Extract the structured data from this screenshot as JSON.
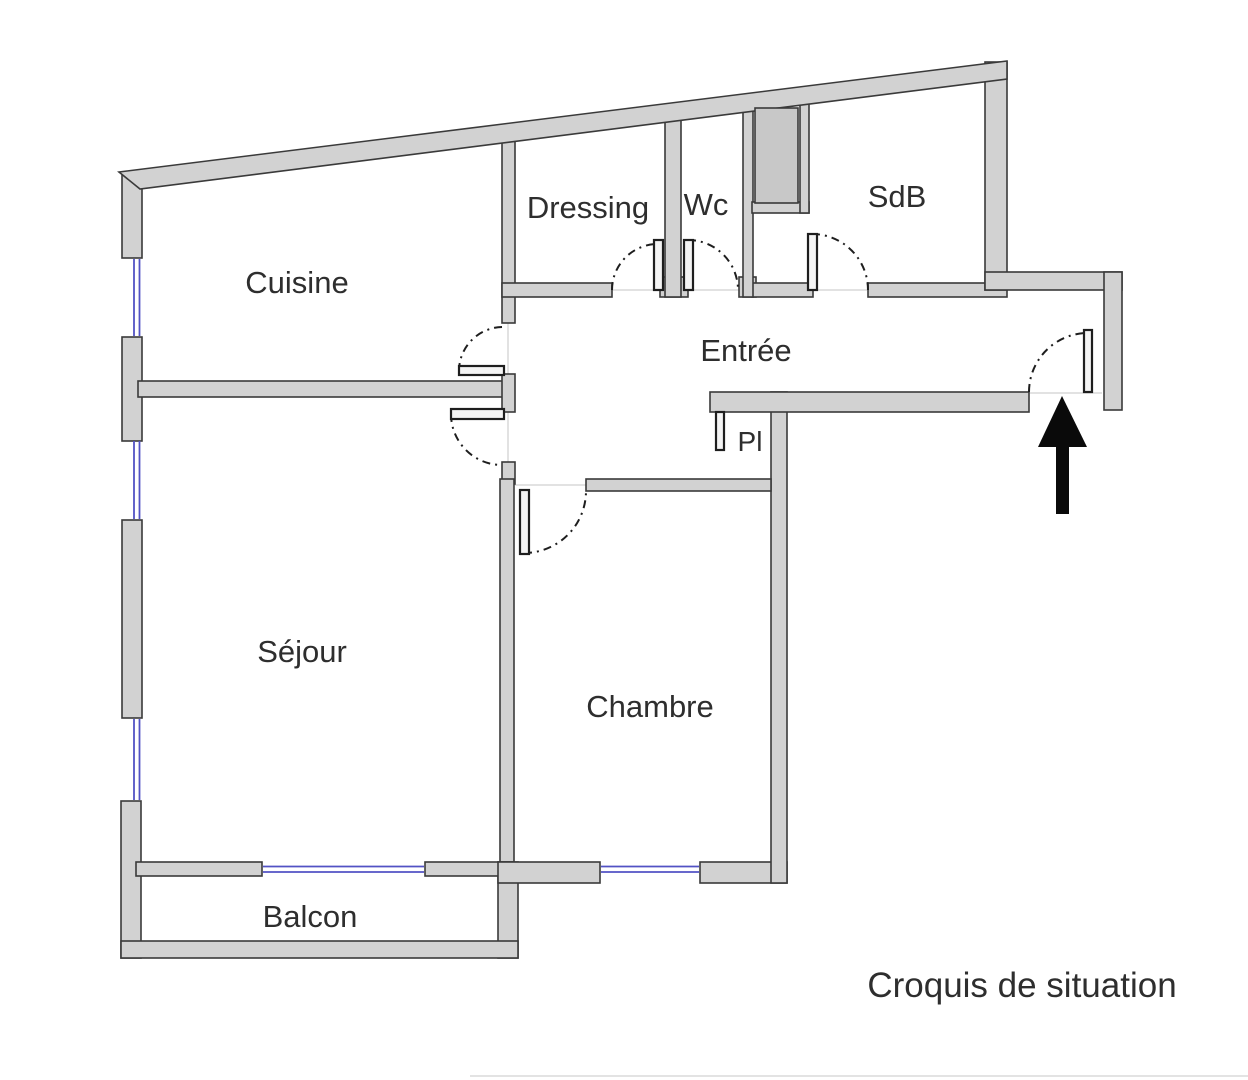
{
  "diagram_type": "floor-plan-sketch",
  "caption": "Croquis de situation",
  "rooms": [
    {
      "id": "cuisine",
      "label": "Cuisine"
    },
    {
      "id": "dressing",
      "label": "Dressing"
    },
    {
      "id": "wc",
      "label": "Wc"
    },
    {
      "id": "sdb",
      "label": "SdB"
    },
    {
      "id": "entree",
      "label": "Entrée"
    },
    {
      "id": "pl",
      "label": "Pl"
    },
    {
      "id": "sejour",
      "label": "Séjour"
    },
    {
      "id": "chambre",
      "label": "Chambre"
    },
    {
      "id": "balcon",
      "label": "Balcon"
    }
  ],
  "icons": {
    "entrance_arrow": "arrow-up"
  },
  "colors": {
    "wall_fill": "#d2d2d2",
    "wall_stroke": "#3a3a3a",
    "shaft_fill": "#c8c8c8",
    "window_blue": "#5252c4",
    "door_line": "#1e1e1e",
    "leaf_fill": "#f4f4f4",
    "threshold": "#d8d8d8",
    "text": "#2e2e2e",
    "arrow": "#0a0a0a",
    "artifact_line": "#e3e3e3"
  }
}
